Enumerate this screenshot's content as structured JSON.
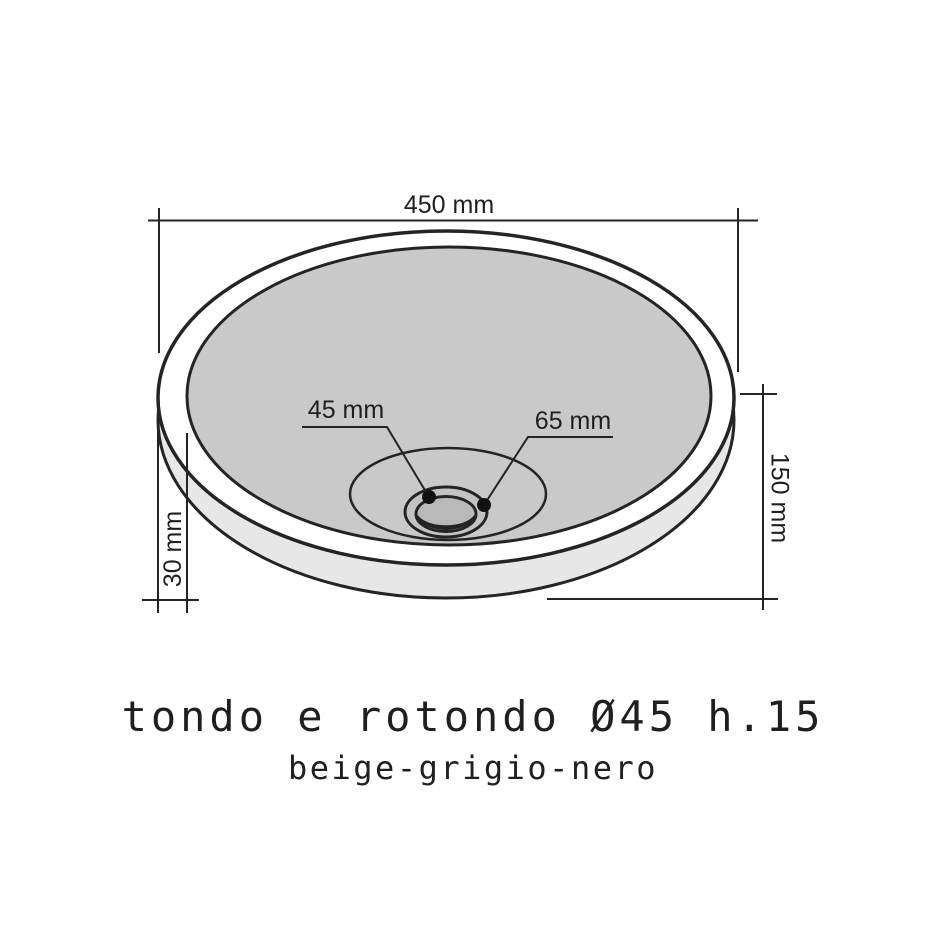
{
  "diagram": {
    "product": {
      "title": "tondo e rotondo Ø45 h.15",
      "subtitle": "beige-grigio-nero"
    },
    "dimensions": {
      "top_width": "450 mm",
      "drain_hole": "45 mm",
      "drain_flange": "65 mm",
      "total_height": "150 mm",
      "base_offset": "30 mm"
    },
    "colors": {
      "line": "#242424",
      "background": "#ffffff",
      "basin_interior": "#c9c9c9",
      "rim_band": "#ffffff",
      "outer_wall": "#e7e7e7",
      "drain_ring": "#c3c3c3",
      "drain_hole": "#b9b9b9",
      "drain_shadow": "#d2d2d2",
      "marker_dot": "#111111"
    }
  }
}
